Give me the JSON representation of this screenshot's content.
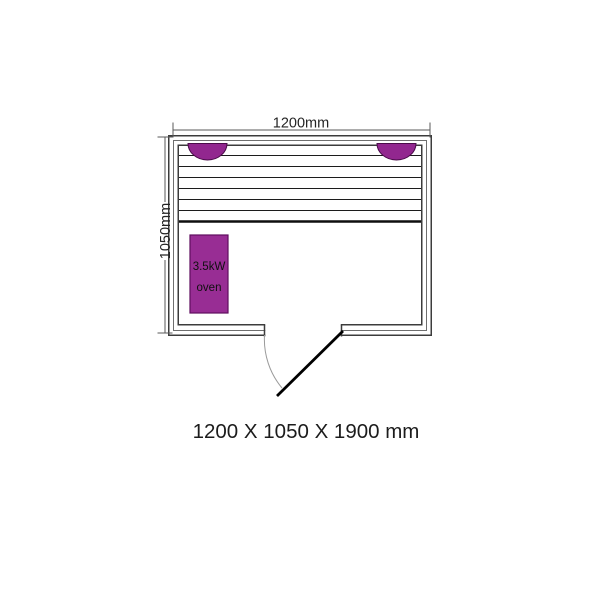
{
  "diagram": {
    "top_width_label": "1200mm",
    "left_depth_label": "1050mm",
    "oven": {
      "line1": "3.5kW",
      "line2": "oven"
    },
    "caption": "1200 X 1050 X 1900 mm",
    "colors": {
      "headrest_purple": "#92278F",
      "headrest_border": "#4A0B49",
      "oven_fill": "#982D94",
      "oven_border": "#5F0D5E",
      "wall_line": "#3C3C3C",
      "dimension_line": "#5A5A5A",
      "door_swing_arc": "#9A9A9A",
      "door_panel": "#000000"
    }
  }
}
